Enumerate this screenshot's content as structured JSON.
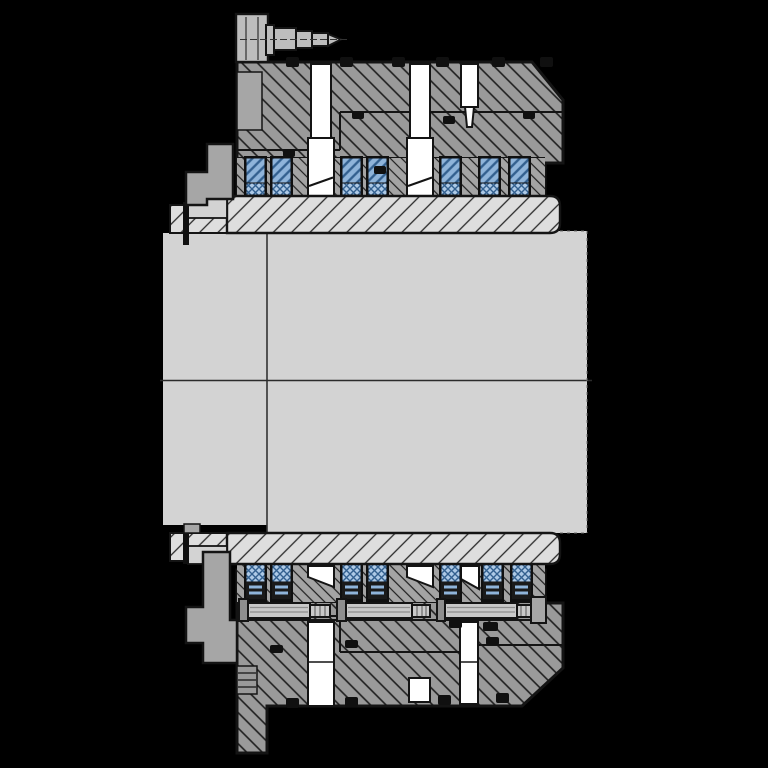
{
  "drawing": {
    "kind": "engineering-cross-section",
    "subject": "Backstop freewheel clutch assembly mounted on a stepped shaft",
    "view": "full section through the shaft axis, upper and lower halves of the clutch visible",
    "text_labels": [],
    "parts": [
      {
        "id": "shaft-large-section",
        "label": "main shaft (large diameter)"
      },
      {
        "id": "shaft-left-section",
        "label": "shaft left stepped section"
      },
      {
        "id": "shaft-centerline",
        "label": "axis centerline"
      },
      {
        "id": "inner-race-sleeve-upper",
        "label": "inner race / sleeve, upper half"
      },
      {
        "id": "inner-race-sleeve-lower",
        "label": "inner race / sleeve, lower half"
      },
      {
        "id": "outer-flange-upper",
        "label": "outer flange housing, upper half"
      },
      {
        "id": "outer-flange-lower",
        "label": "outer flange housing, lower half"
      },
      {
        "id": "roller-cage-upper",
        "label": "sprag / roller cage, upper half"
      },
      {
        "id": "roller-cage-lower",
        "label": "sprag / roller cage, lower half"
      },
      {
        "id": "sprag-roller",
        "label": "sprag roller element with spring"
      },
      {
        "id": "bolt-channel",
        "label": "axial bolt hole channel"
      },
      {
        "id": "seal-ring",
        "label": "O-ring / seal"
      },
      {
        "id": "mounting-bracket-upper",
        "label": "torque arm bracket, upper"
      },
      {
        "id": "mounting-bracket-lower",
        "label": "torque arm bracket, lower"
      },
      {
        "id": "grease-fitting",
        "label": "grease nipple (zerk fitting)"
      },
      {
        "id": "clamp-bolt",
        "label": "axial clamping bolt"
      },
      {
        "id": "threaded-hole",
        "label": "tapped hole with thread lines"
      },
      {
        "id": "bottom-boss",
        "label": "lower flange boss"
      }
    ]
  },
  "colors": {
    "background": "#000000",
    "ink": "#141414",
    "hatchline": "#1e1e1e",
    "housing": "#9a9a9a",
    "cage": "#a4a4a4",
    "sleeve": "#dedede",
    "steel": "#d3d3d3",
    "face": "#a6a6a6",
    "metal": "#bdbdbd",
    "white": "#ffffff",
    "black": "#101010",
    "blue_light": "#8fb4da",
    "blue_dark": "#33608f",
    "blue_pale": "#adc9e6",
    "bolt": "#c9c9c9",
    "bolt_line": "#8f8f8f",
    "washer": "#8e8e8e",
    "faint": "#6f6f6f"
  }
}
